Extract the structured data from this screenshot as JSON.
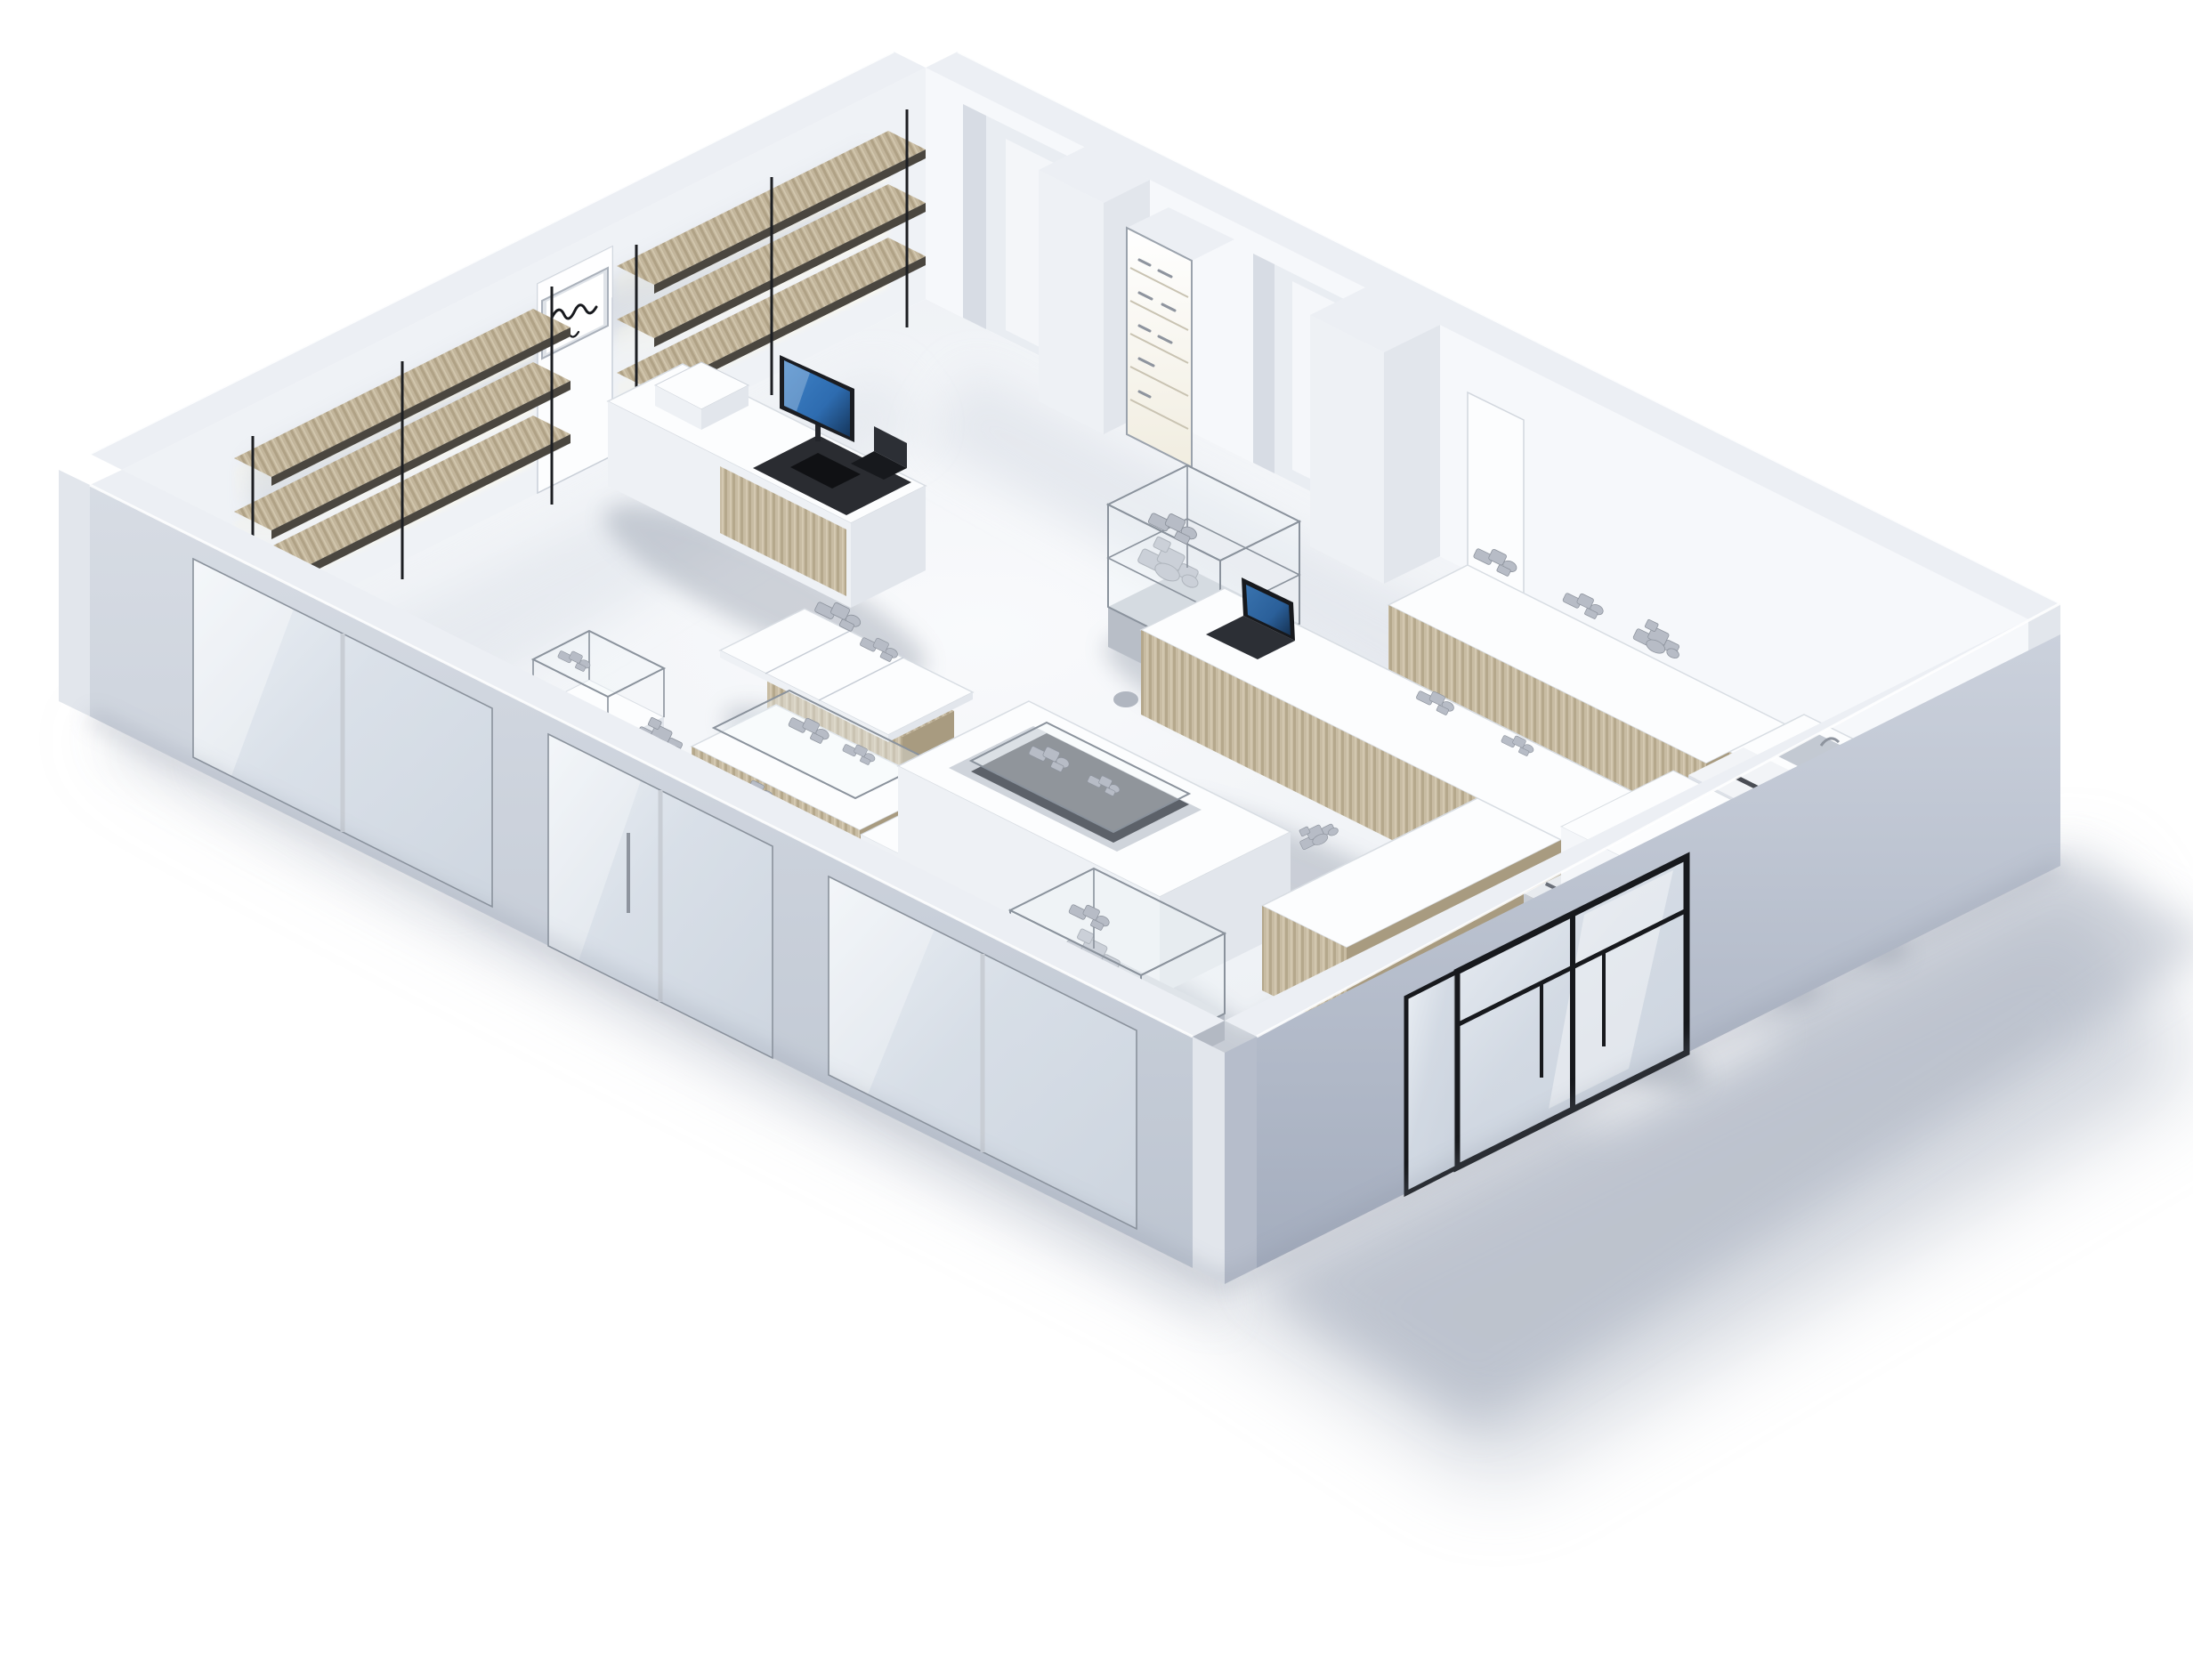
{
  "scene": {
    "title": "Isometric 3D render of a minimalist retail store interior",
    "description": "Photorealistic isometric cutaway rendering of a white retail store: wood wall shelving with LED lighting and a script logo sign on the back-left wall, doorway alcoves, pillars and a lit display column on the back-right wall, a checkout counter with monitor, glass display cases and wood-front display counters across the floor, an appliance counter with service cart and tall cabinet near the right corner, a coat ledge with hooks beside the black-framed glass entrance door on the front-right wall, and a glazed storefront with sliding doors on the front-left wall. Soft shadow falls to the bottom right.",
    "style": "monochrome white and gray with light wood accents, strong top-left daylight",
    "objects": [
      {
        "name": "floor",
        "label": "Store floor"
      },
      {
        "name": "back-left-wall",
        "label": "Back-left wall with shelving"
      },
      {
        "name": "wall-shelving-run-1",
        "label": "Wood wall shelving with LED strips (rear run)"
      },
      {
        "name": "wall-shelving-run-2",
        "label": "Wood wall shelving with LED strips (left run)"
      },
      {
        "name": "brand-sign",
        "label": "Chrome sign panel with illegible script logo"
      },
      {
        "name": "wall-door-panel",
        "label": "White wall door panel"
      },
      {
        "name": "back-right-wall",
        "label": "Back-right wall"
      },
      {
        "name": "doorway-alcove-1",
        "label": "Recessed doorway alcove"
      },
      {
        "name": "doorway-alcove-2",
        "label": "Recessed passage alcove"
      },
      {
        "name": "wall-pillar-1",
        "label": "Protruding wall pillar"
      },
      {
        "name": "wall-pillar-2",
        "label": "Protruding wall pillar"
      },
      {
        "name": "lit-display-column",
        "label": "Backlit vertical display case"
      },
      {
        "name": "wall-accent-panel",
        "label": "White wall accent panel"
      },
      {
        "name": "checkout-counter",
        "label": "Checkout counter with monitor, keyboard, terminal and printer"
      },
      {
        "name": "glass-display-cart",
        "label": "Glass display case on rolling cart"
      },
      {
        "name": "display-table-white",
        "label": "White display table with wood storage boxes"
      },
      {
        "name": "display-table-glass",
        "label": "Glass-top display counter"
      },
      {
        "name": "side-table",
        "label": "Small white side table"
      },
      {
        "name": "accessory-stand",
        "label": "Small glass accessory stand"
      },
      {
        "name": "long-display-counter",
        "label": "Long wood-front display counter"
      },
      {
        "name": "l-shaped-counter",
        "label": "L-shaped wood-front counter with laptop"
      },
      {
        "name": "island-display-counter",
        "label": "Island counter with recessed display tray"
      },
      {
        "name": "low-display-counter",
        "label": "Low wood-front display counter"
      },
      {
        "name": "glass-display-case-1",
        "label": "Glass display case with merchandise"
      },
      {
        "name": "glass-display-case-2",
        "label": "Glass display case with merchandise"
      },
      {
        "name": "legged-display-table",
        "label": "Pedestal table with glass merchandise case"
      },
      {
        "name": "appliance-counter",
        "label": "Appliance counter with sink and coffee machine"
      },
      {
        "name": "service-cart",
        "label": "Rolling drawer cart with printer"
      },
      {
        "name": "tall-cabinet",
        "label": "Tall white cabinet"
      },
      {
        "name": "device-pedestal",
        "label": "White pedestal with device"
      },
      {
        "name": "coat-ledge",
        "label": "Wall ledge with metal hooks"
      },
      {
        "name": "storefront-wall",
        "label": "Storefront wall with glass windows and sliding door"
      },
      {
        "name": "entrance-wall",
        "label": "Entrance wall with black-framed glass door"
      },
      {
        "name": "building-shadow",
        "label": "Soft cast shadow"
      }
    ]
  },
  "sign": {
    "script": "illegible handwritten brand script",
    "ink": "#17191d"
  },
  "palette": {
    "bg": "#ffffff",
    "floor_light": "#f8f9fb",
    "floor_shade": "#e2e6ec",
    "wall_int_left": "#eff2f6",
    "wall_int_right": "#f6f8fb",
    "wall_top": "#eceff4",
    "wall_ext_light": "#d3d8e1",
    "wall_ext_dark": "#a9b2c2",
    "recess": "#e9edf2",
    "white_surface": "#fcfdfe",
    "white_shade": "#eef1f5",
    "side_shade": "#e2e6ec",
    "wood_light": "#cdc1a9",
    "wood_mid": "#bcae92",
    "wood_dark": "#a99b7e",
    "shelf_edge": "#4a463f",
    "frame_black": "#17191d",
    "glass_fill": "#f0f5fa",
    "glass_edge": "#8a929c",
    "led_glow": "#fff6d8",
    "screen_blue": "#2e6cb0",
    "screen_dark": "#15365c",
    "product": "#b7bcc6",
    "product_dark": "#8e949e",
    "chrome": "#dfe3e8",
    "shadow": "#a8b0bf"
  }
}
